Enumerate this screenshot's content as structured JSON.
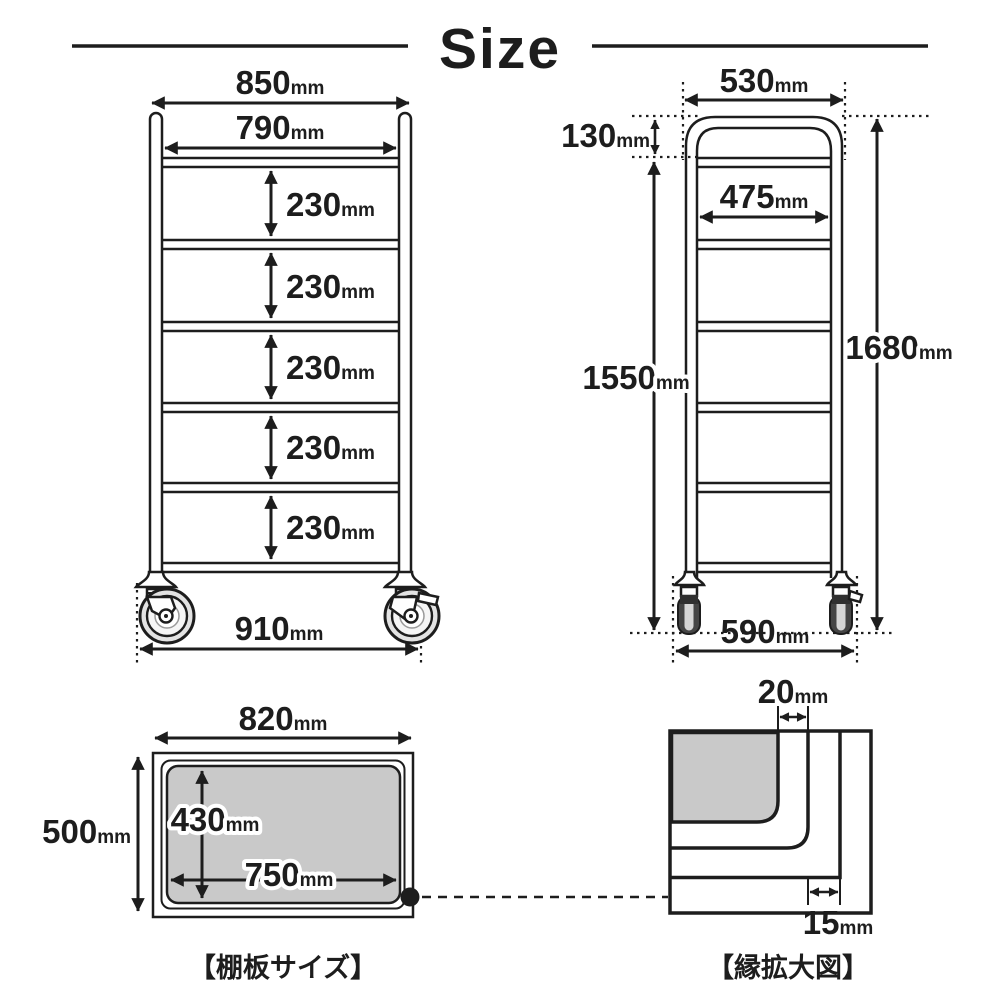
{
  "title": "Size",
  "unit": "mm",
  "front_view": {
    "overall_width": "850",
    "shelf_width": "790",
    "shelf_gaps": [
      "230",
      "230",
      "230",
      "230",
      "230"
    ],
    "caster_span": "910"
  },
  "side_view": {
    "top_depth": "530",
    "handle_height": "130",
    "inner_depth": "475",
    "shelf_top_height": "1550",
    "overall_height": "1680",
    "caster_span": "590"
  },
  "shelf_board": {
    "caption": "【棚板サイズ】",
    "outer_width": "820",
    "outer_depth": "500",
    "inner_width": "750",
    "inner_depth": "430"
  },
  "edge_detail": {
    "caption": "【縁拡大図】",
    "top_offset": "20",
    "bottom_offset": "15"
  },
  "colors": {
    "line": "#1d1d1d",
    "gray_fill": "#c9c9c9",
    "background": "#ffffff"
  }
}
